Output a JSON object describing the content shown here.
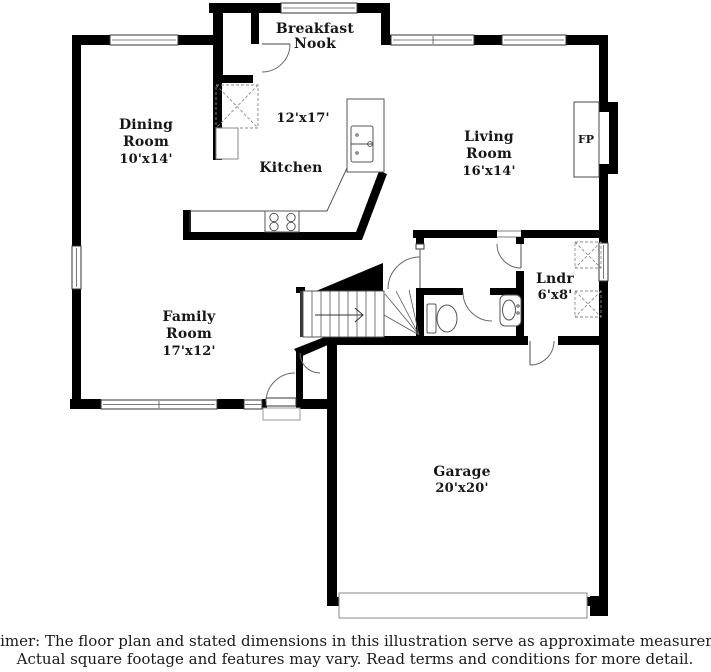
{
  "floorplan": {
    "rooms": {
      "breakfast_nook": {
        "line1": "Breakfast",
        "line2": "Nook"
      },
      "dining": {
        "line1": "Dining",
        "line2": "Room",
        "dims": "10'x14'"
      },
      "kitchen": {
        "name": "Kitchen",
        "dims": "12'x17'"
      },
      "living": {
        "line1": "Living",
        "line2": "Room",
        "dims": "16'x14'"
      },
      "family": {
        "line1": "Family",
        "line2": "Room",
        "dims": "17'x12'"
      },
      "laundry": {
        "name": "Lndr",
        "dims": "6'x8'"
      },
      "garage": {
        "name": "Garage",
        "dims": "20'x20'"
      },
      "fireplace": {
        "label": "FP"
      }
    },
    "colors": {
      "wall": "#000000",
      "thin_line": "#4a4a4a",
      "label": "#161616"
    }
  },
  "disclaimer": {
    "line1": "Disclaimer: The floor plan and stated dimensions in this illustration serve as approximate measurements.",
    "line2": "Actual square footage and features may vary. Read terms and conditions for more detail."
  }
}
